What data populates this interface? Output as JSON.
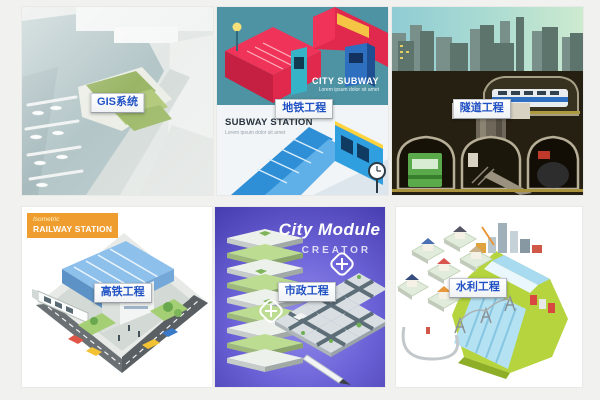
{
  "page": {
    "background": "#f1f1f0"
  },
  "colors": {
    "button_text_blue": "#2152c3",
    "badge_orange": "#ef9d2f",
    "subway_red": "#e8294c",
    "subway_teal": "#4e93a3",
    "city_module_purple": "#5a50c8",
    "dam_green": "#b5d43e"
  },
  "tiles": [
    {
      "label": "GIS系统"
    },
    {
      "label": "地铁工程",
      "top_poster": {
        "title": "CITY SUBWAY",
        "subtitle": "Lorem ipsum dolor sit amet"
      },
      "bottom_poster": {
        "title": "SUBWAY STATION",
        "subtitle": "Lorem ipsum dolor sit amet"
      }
    },
    {
      "label": "隧道工程"
    },
    {
      "label": "高铁工程",
      "badge": {
        "line1": "Isometric",
        "line2": "RAILWAY STATION"
      }
    },
    {
      "label": "市政工程",
      "poster": {
        "title": "City Module",
        "subtitle": "CREATOR"
      }
    },
    {
      "label": "水利工程"
    }
  ]
}
